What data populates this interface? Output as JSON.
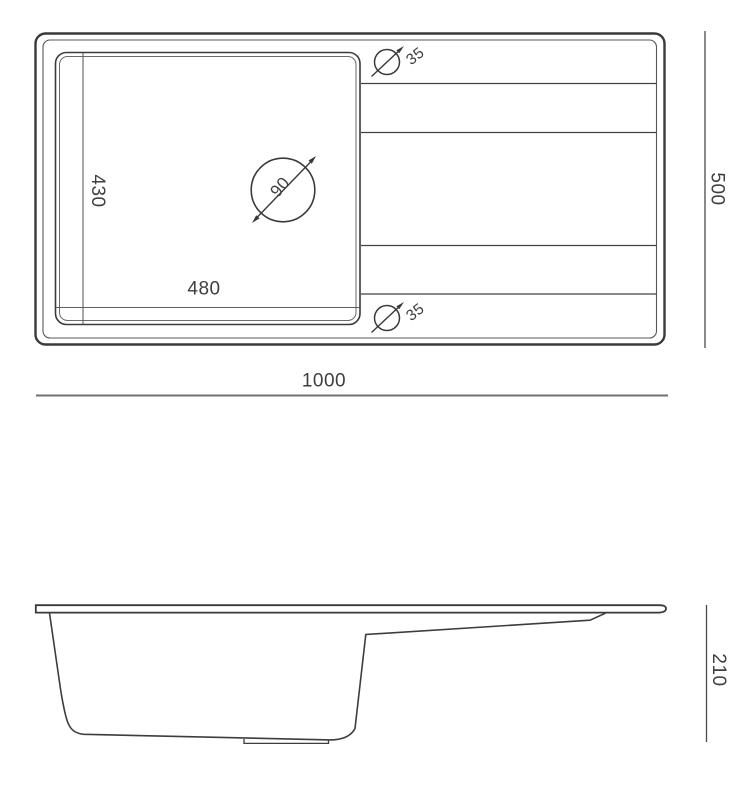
{
  "drawing": {
    "top_view": {
      "overall_width": "1000",
      "overall_depth": "500",
      "bowl_width": "480",
      "bowl_depth": "430",
      "main_drain_diameter": "90",
      "tap_hole_top_diameter": "35",
      "tap_hole_bottom_diameter": "35"
    },
    "side_view": {
      "overall_height": "210"
    },
    "colors": {
      "background": "#ffffff",
      "outline": "#3a3a3a",
      "detail_line": "#5f5f5f",
      "dimension_line": "#6e6e6e",
      "label_text": "#3f3f3f"
    }
  }
}
